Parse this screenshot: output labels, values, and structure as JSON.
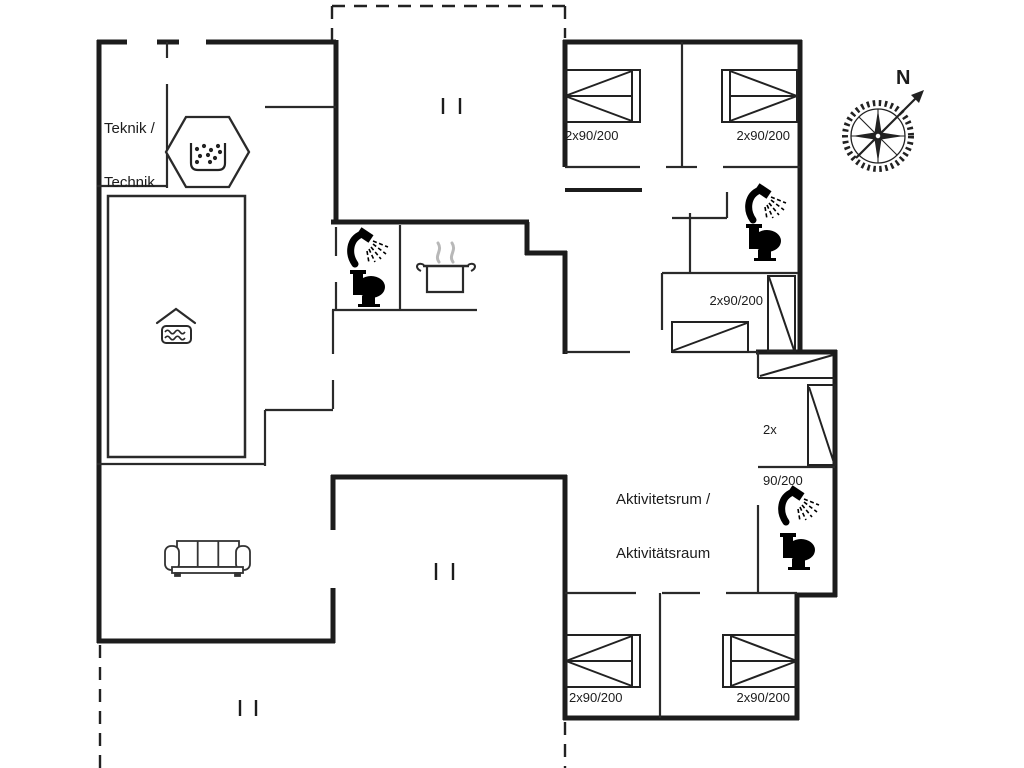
{
  "colors": {
    "background": "#ffffff",
    "walls": "#1c1c1c",
    "thin_walls": "#2a2a2a",
    "steam": "#b8b8b8"
  },
  "rooms": {
    "technical": {
      "label_line1": "Teknik /",
      "label_line2": "Technik"
    },
    "activity": {
      "label_line1": "Aktivitetsrum /",
      "label_line2": "Aktivitätsraum"
    }
  },
  "beds": {
    "bunk_label_line1": "2x",
    "bunk_label_line2": "90/200",
    "instances": [
      {
        "id": "bedroom-top-left",
        "label": "2x90/200"
      },
      {
        "id": "bedroom-top-right",
        "label": "2x90/200"
      },
      {
        "id": "bedroom-middle-right",
        "label": "2x90/200"
      },
      {
        "id": "bedroom-bottom-left",
        "label": "2x90/200"
      },
      {
        "id": "bedroom-bottom-right",
        "label": "2x90/200"
      }
    ]
  },
  "compass": {
    "north_label": "N"
  },
  "icons": {
    "shower": "shower-icon",
    "toilet": "toilet-icon",
    "pool": "pool-icon",
    "spa": "spa-bubbles-icon",
    "stove_pot": "cooking-pot-icon",
    "sofa": "sofa-icon",
    "compass": "compass-rose-icon"
  }
}
